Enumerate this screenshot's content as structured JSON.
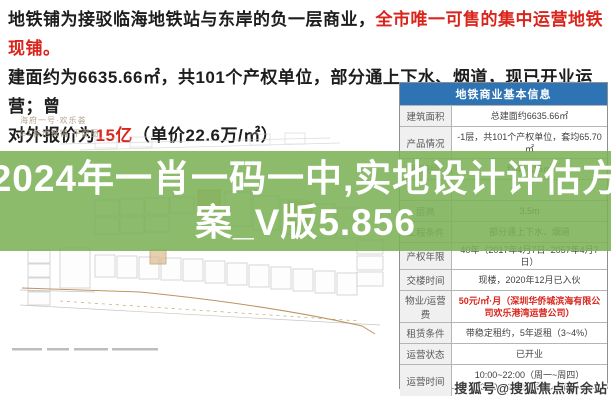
{
  "header": {
    "line1_black": "地铁铺为接驳临海地铁站与东岸的负一层商业，",
    "line1_red": "全市唯一可售的集中运营地铁现铺。",
    "line2": "建面约为6635.66㎡，共101个产权单位，部分通上下水、烟道，现已开业运营；曾",
    "line3_black1": "对外报价为",
    "line3_red": "15亿",
    "line3_black2": "（单价22.6万/㎡）"
  },
  "plan": {
    "title_line1": "海府一号·欢乐荟",
    "title_line2": "G1栋地铁铺·平面图"
  },
  "overlay": {
    "line1": "2024年一肖一码一中,实地设计评估方",
    "line2": "案_V版5.856"
  },
  "table": {
    "title": "地铁商业基本信息",
    "rows": [
      {
        "label": "建筑面积",
        "value": "总建面约6635.66㎡"
      },
      {
        "label": "产品情况",
        "value": "-1层，共101个产权单位，套均65.70㎡"
      },
      {
        "label": "面积段",
        "value": "约42-115㎡"
      },
      {
        "label": "",
        "value": ""
      },
      {
        "label": "层高",
        "value": "3.5m"
      },
      {
        "label": "工程条件",
        "value": "部分通上下水、烟道"
      },
      {
        "label": "产权年限",
        "value": "40年（2017年4月7日~2057年4月7日）"
      },
      {
        "label": "交楼时间",
        "value": "现楼，2020年12月已入伙"
      },
      {
        "label": "物业/运营费",
        "value": "50元/㎡·月（深圳华侨城滨海有限公司欢乐港湾运营公司）"
      },
      {
        "label": "租赁条件",
        "value": "带稳定租约，5年返租（3~4%）"
      },
      {
        "label": "运营状态",
        "value": "已开业"
      },
      {
        "label": "运营时间",
        "value": "10:00~22:00（周一~周四）",
        "value2": "10:00~22:30（周五~周日）"
      }
    ]
  },
  "watermark": {
    "text": "搜狐号@搜狐焦点新余站"
  },
  "colors": {
    "red": "#d9251c",
    "table_header_blue": "#2e74b5",
    "overlay_green": "#7db258",
    "plan_line_gray": "#c6c6c6",
    "plan_tan": "#bd9460"
  }
}
